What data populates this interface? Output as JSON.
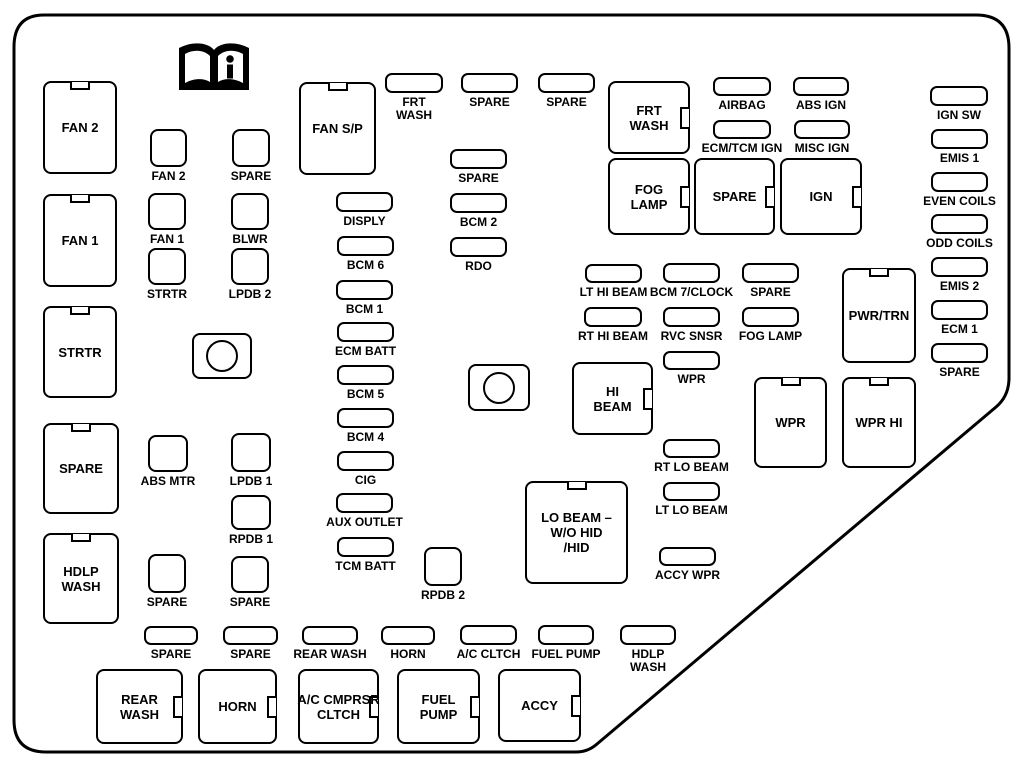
{
  "diagram_type": "engine compartment fuse box diagram",
  "line_color": "#000000",
  "background_color": "#ffffff",
  "icon": {
    "name": "info-book-icon",
    "glyph": "i"
  },
  "boxes": {
    "large": [
      {
        "name": "fan2-relay",
        "label": [
          "FAN 2"
        ],
        "x": 43,
        "y": 81,
        "w": 74,
        "h": 93,
        "notch": "top"
      },
      {
        "name": "fan1-relay",
        "label": [
          "FAN 1"
        ],
        "x": 43,
        "y": 194,
        "w": 74,
        "h": 93,
        "notch": "top"
      },
      {
        "name": "strtr-relay",
        "label": [
          "STRTR"
        ],
        "x": 43,
        "y": 306,
        "w": 74,
        "h": 92,
        "notch": "top"
      },
      {
        "name": "spare-relay-left",
        "label": [
          "SPARE"
        ],
        "x": 43,
        "y": 423,
        "w": 76,
        "h": 91,
        "notch": "top"
      },
      {
        "name": "hdlp-wash-relay-left",
        "label": [
          "HDLP",
          "WASH"
        ],
        "x": 43,
        "y": 533,
        "w": 76,
        "h": 91,
        "notch": "top"
      },
      {
        "name": "fan-sp-relay",
        "label": [
          "FAN S/P"
        ],
        "x": 299,
        "y": 82,
        "w": 77,
        "h": 93,
        "notch": "top"
      },
      {
        "name": "frt-wash-relay",
        "label": [
          "FRT",
          "WASH"
        ],
        "x": 608,
        "y": 81,
        "w": 82,
        "h": 73,
        "notch": "right"
      },
      {
        "name": "fog-lamp-relay",
        "label": [
          "FOG",
          "LAMP"
        ],
        "x": 608,
        "y": 158,
        "w": 82,
        "h": 77,
        "notch": "right"
      },
      {
        "name": "spare-relay-mid",
        "label": [
          "SPARE"
        ],
        "x": 694,
        "y": 158,
        "w": 81,
        "h": 77,
        "notch": "right"
      },
      {
        "name": "ign-relay",
        "label": [
          "IGN"
        ],
        "x": 780,
        "y": 158,
        "w": 82,
        "h": 77,
        "notch": "right"
      },
      {
        "name": "hi-beam-relay",
        "label": [
          "HI",
          "BEAM"
        ],
        "x": 572,
        "y": 362,
        "w": 81,
        "h": 73,
        "notch": "right"
      },
      {
        "name": "lo-beam-relay",
        "label": [
          "LO BEAM –",
          "W/O HID",
          "/HID"
        ],
        "x": 525,
        "y": 481,
        "w": 103,
        "h": 103,
        "notch": "top"
      },
      {
        "name": "wpr-relay",
        "label": [
          "WPR"
        ],
        "x": 754,
        "y": 377,
        "w": 73,
        "h": 91,
        "notch": "top"
      },
      {
        "name": "wpr-hi-relay",
        "label": [
          "WPR HI"
        ],
        "x": 842,
        "y": 377,
        "w": 74,
        "h": 91,
        "notch": "top"
      },
      {
        "name": "pwr-trn-relay",
        "label": [
          "PWR/TRN"
        ],
        "x": 842,
        "y": 268,
        "w": 74,
        "h": 95,
        "notch": "top"
      },
      {
        "name": "rear-wash-relay",
        "label": [
          "REAR",
          "WASH"
        ],
        "x": 96,
        "y": 669,
        "w": 87,
        "h": 75,
        "notch": "right"
      },
      {
        "name": "horn-relay",
        "label": [
          "HORN"
        ],
        "x": 198,
        "y": 669,
        "w": 79,
        "h": 75,
        "notch": "right"
      },
      {
        "name": "ac-cmprsr-cltch-relay",
        "label": [
          "A/C CMPRSR",
          "CLTCH"
        ],
        "x": 298,
        "y": 669,
        "w": 81,
        "h": 75,
        "notch": "right"
      },
      {
        "name": "fuel-pump-relay",
        "label": [
          "FUEL",
          "PUMP"
        ],
        "x": 397,
        "y": 669,
        "w": 83,
        "h": 75,
        "notch": "right"
      },
      {
        "name": "accy-relay",
        "label": [
          "ACCY"
        ],
        "x": 498,
        "y": 669,
        "w": 83,
        "h": 73,
        "notch": "right"
      }
    ],
    "fuses": [
      {
        "name": "frt-wash-fuse",
        "label": [
          "FRT",
          "WASH"
        ],
        "x": 385,
        "y": 73,
        "w": 58,
        "h": 20
      },
      {
        "name": "spare-fuse-top-1",
        "label": [
          "SPARE"
        ],
        "x": 461,
        "y": 73,
        "w": 57,
        "h": 20
      },
      {
        "name": "spare-fuse-top-2",
        "label": [
          "SPARE"
        ],
        "x": 538,
        "y": 73,
        "w": 57,
        "h": 20
      },
      {
        "name": "spare-fuse-mid",
        "label": [
          "SPARE"
        ],
        "x": 450,
        "y": 149,
        "w": 57,
        "h": 20
      },
      {
        "name": "bcm2-fuse",
        "label": [
          "BCM 2"
        ],
        "x": 450,
        "y": 193,
        "w": 57,
        "h": 20
      },
      {
        "name": "rdo-fuse",
        "label": [
          "RDO"
        ],
        "x": 450,
        "y": 237,
        "w": 57,
        "h": 20
      },
      {
        "name": "disply-fuse",
        "label": [
          "DISPLY"
        ],
        "x": 336,
        "y": 192,
        "w": 57,
        "h": 20
      },
      {
        "name": "bcm6-fuse",
        "label": [
          "BCM 6"
        ],
        "x": 337,
        "y": 236,
        "w": 57,
        "h": 20
      },
      {
        "name": "bcm1-fuse",
        "label": [
          "BCM 1"
        ],
        "x": 336,
        "y": 280,
        "w": 57,
        "h": 20
      },
      {
        "name": "ecm-batt-fuse",
        "label": [
          "ECM BATT"
        ],
        "x": 337,
        "y": 322,
        "w": 57,
        "h": 20
      },
      {
        "name": "bcm5-fuse",
        "label": [
          "BCM 5"
        ],
        "x": 337,
        "y": 365,
        "w": 57,
        "h": 20
      },
      {
        "name": "bcm4-fuse",
        "label": [
          "BCM 4"
        ],
        "x": 337,
        "y": 408,
        "w": 57,
        "h": 20
      },
      {
        "name": "cig-fuse",
        "label": [
          "CIG"
        ],
        "x": 337,
        "y": 451,
        "w": 57,
        "h": 20
      },
      {
        "name": "aux-outlet-fuse",
        "label": [
          "AUX OUTLET"
        ],
        "x": 336,
        "y": 493,
        "w": 57,
        "h": 20
      },
      {
        "name": "tcm-batt-fuse",
        "label": [
          "TCM BATT"
        ],
        "x": 337,
        "y": 537,
        "w": 57,
        "h": 20
      },
      {
        "name": "airbag-fuse",
        "label": [
          "AIRBAG"
        ],
        "x": 713,
        "y": 77,
        "w": 58,
        "h": 19
      },
      {
        "name": "abs-ign-fuse",
        "label": [
          "ABS IGN"
        ],
        "x": 793,
        "y": 77,
        "w": 56,
        "h": 19
      },
      {
        "name": "ecm-tcm-ign-fuse",
        "label": [
          "ECM/TCM IGN"
        ],
        "x": 713,
        "y": 120,
        "w": 58,
        "h": 19
      },
      {
        "name": "misc-ign-fuse",
        "label": [
          "MISC IGN"
        ],
        "x": 794,
        "y": 120,
        "w": 56,
        "h": 19
      },
      {
        "name": "ign-sw-fuse",
        "label": [
          "IGN SW"
        ],
        "x": 930,
        "y": 86,
        "w": 58,
        "h": 20
      },
      {
        "name": "emis1-fuse",
        "label": [
          "EMIS 1"
        ],
        "x": 931,
        "y": 129,
        "w": 57,
        "h": 20
      },
      {
        "name": "even-coils-fuse",
        "label": [
          "EVEN COILS"
        ],
        "x": 931,
        "y": 172,
        "w": 57,
        "h": 20
      },
      {
        "name": "odd-coils-fuse",
        "label": [
          "ODD COILS"
        ],
        "x": 931,
        "y": 214,
        "w": 57,
        "h": 20
      },
      {
        "name": "emis2-fuse",
        "label": [
          "EMIS 2"
        ],
        "x": 931,
        "y": 257,
        "w": 57,
        "h": 20
      },
      {
        "name": "ecm1-fuse",
        "label": [
          "ECM 1"
        ],
        "x": 931,
        "y": 300,
        "w": 57,
        "h": 20
      },
      {
        "name": "spare-fuse-right-col",
        "label": [
          "SPARE"
        ],
        "x": 931,
        "y": 343,
        "w": 57,
        "h": 20
      },
      {
        "name": "lt-hi-beam-fuse",
        "label": [
          "LT HI BEAM"
        ],
        "x": 585,
        "y": 264,
        "w": 57,
        "h": 19
      },
      {
        "name": "bcm7-clock-fuse",
        "label": [
          "BCM 7/CLOCK"
        ],
        "x": 663,
        "y": 263,
        "w": 57,
        "h": 20
      },
      {
        "name": "spare-fuse-mid-right",
        "label": [
          "SPARE"
        ],
        "x": 742,
        "y": 263,
        "w": 57,
        "h": 20
      },
      {
        "name": "rt-hi-beam-fuse",
        "label": [
          "RT HI BEAM"
        ],
        "x": 584,
        "y": 307,
        "w": 58,
        "h": 20
      },
      {
        "name": "rvc-snsr-fuse",
        "label": [
          "RVC SNSR"
        ],
        "x": 663,
        "y": 307,
        "w": 57,
        "h": 20
      },
      {
        "name": "fog-lamp-fuse",
        "label": [
          "FOG LAMP"
        ],
        "x": 742,
        "y": 307,
        "w": 57,
        "h": 20
      },
      {
        "name": "wpr-fuse",
        "label": [
          "WPR"
        ],
        "x": 663,
        "y": 351,
        "w": 57,
        "h": 19
      },
      {
        "name": "rt-lo-beam-fuse",
        "label": [
          "RT LO BEAM"
        ],
        "x": 663,
        "y": 439,
        "w": 57,
        "h": 19
      },
      {
        "name": "lt-lo-beam-fuse",
        "label": [
          "LT LO BEAM"
        ],
        "x": 663,
        "y": 482,
        "w": 57,
        "h": 19
      },
      {
        "name": "accy-wpr-fuse",
        "label": [
          "ACCY WPR"
        ],
        "x": 659,
        "y": 547,
        "w": 57,
        "h": 19
      },
      {
        "name": "spare-fuse-bottom-1",
        "label": [
          "SPARE"
        ],
        "x": 144,
        "y": 626,
        "w": 54,
        "h": 19
      },
      {
        "name": "spare-fuse-bottom-2",
        "label": [
          "SPARE"
        ],
        "x": 223,
        "y": 626,
        "w": 55,
        "h": 19
      },
      {
        "name": "rear-wash-fuse",
        "label": [
          "REAR WASH"
        ],
        "x": 302,
        "y": 626,
        "w": 56,
        "h": 19
      },
      {
        "name": "horn-fuse",
        "label": [
          "HORN"
        ],
        "x": 381,
        "y": 626,
        "w": 54,
        "h": 19
      },
      {
        "name": "ac-cltch-fuse",
        "label": [
          "A/C CLTCH"
        ],
        "x": 460,
        "y": 625,
        "w": 57,
        "h": 20
      },
      {
        "name": "fuel-pump-fuse",
        "label": [
          "FUEL PUMP"
        ],
        "x": 538,
        "y": 625,
        "w": 56,
        "h": 20
      },
      {
        "name": "hdlp-wash-fuse",
        "label": [
          "HDLP",
          "WASH"
        ],
        "x": 620,
        "y": 625,
        "w": 56,
        "h": 20
      }
    ],
    "squares": [
      {
        "name": "fan2-sq-fuse",
        "label": [
          "FAN 2"
        ],
        "x": 150,
        "y": 129,
        "w": 37,
        "h": 38
      },
      {
        "name": "spare-sq-1",
        "label": [
          "SPARE"
        ],
        "x": 232,
        "y": 129,
        "w": 38,
        "h": 38
      },
      {
        "name": "fan1-sq-fuse",
        "label": [
          "FAN 1"
        ],
        "x": 148,
        "y": 193,
        "w": 38,
        "h": 37
      },
      {
        "name": "blwr-sq-fuse",
        "label": [
          "BLWR"
        ],
        "x": 231,
        "y": 193,
        "w": 38,
        "h": 37
      },
      {
        "name": "strtr-sq-fuse",
        "label": [
          "STRTR"
        ],
        "x": 148,
        "y": 248,
        "w": 38,
        "h": 37
      },
      {
        "name": "lpdb2-sq-fuse",
        "label": [
          "LPDB 2"
        ],
        "x": 231,
        "y": 248,
        "w": 38,
        "h": 37
      },
      {
        "name": "abs-mtr-sq-fuse",
        "label": [
          "ABS MTR"
        ],
        "x": 148,
        "y": 435,
        "w": 40,
        "h": 37
      },
      {
        "name": "lpdb1-sq-fuse",
        "label": [
          "LPDB 1"
        ],
        "x": 231,
        "y": 433,
        "w": 40,
        "h": 39
      },
      {
        "name": "rpdb1-sq-fuse",
        "label": [
          "RPDB 1"
        ],
        "x": 231,
        "y": 495,
        "w": 40,
        "h": 35
      },
      {
        "name": "spare-sq-2",
        "label": [
          "SPARE"
        ],
        "x": 148,
        "y": 554,
        "w": 38,
        "h": 39
      },
      {
        "name": "spare-sq-3",
        "label": [
          "SPARE"
        ],
        "x": 231,
        "y": 556,
        "w": 38,
        "h": 37
      },
      {
        "name": "rpdb2-sq-fuse",
        "label": [
          "RPDB 2"
        ],
        "x": 424,
        "y": 547,
        "w": 38,
        "h": 39
      }
    ],
    "relays": [
      {
        "name": "relay-circle-1",
        "x": 192,
        "y": 333,
        "w": 60,
        "h": 46
      },
      {
        "name": "relay-circle-2",
        "x": 468,
        "y": 364,
        "w": 62,
        "h": 47
      }
    ]
  }
}
